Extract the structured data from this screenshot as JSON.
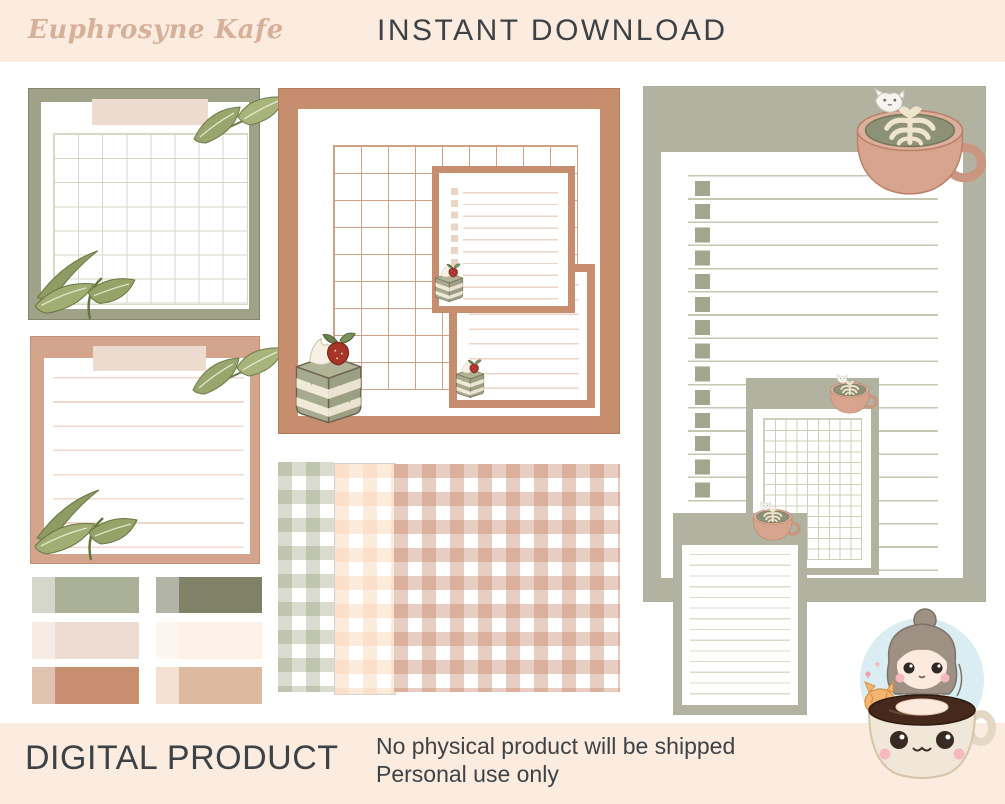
{
  "header": {
    "brand": "Euphrosyne Kafe",
    "title": "INSTANT DOWNLOAD"
  },
  "footer": {
    "label": "DIGITAL PRODUCT",
    "line1": "No physical product will be shipped",
    "line2": "Personal use only"
  },
  "colors": {
    "band_background": "#fcecdf",
    "brand_script": "#d6b098",
    "text_dark": "#3d4246",
    "sage_olive": "#a0a287",
    "sage_gray": "#b1b3a0",
    "tan": "#d3a58c",
    "terracotta": "#c68e6f"
  },
  "palette_swatches": [
    {
      "light": "#d4d7c9",
      "dark": "#a9b096"
    },
    {
      "light": "#b2b4a6",
      "dark": "#808268"
    },
    {
      "light": "#f7ece4",
      "dark": "#eddcd2"
    },
    {
      "light": "#fdf6ef",
      "dark": "#fdf0e6"
    },
    {
      "light": "#e0c2b0",
      "dark": "#c78f6f"
    },
    {
      "light": "#f4e1d4",
      "dark": "#dcba9f"
    }
  ],
  "templates": {
    "calendar_note": {
      "grid_cols": 8,
      "grid_rows": 7
    },
    "lined_note": {
      "lines": 8
    },
    "planner_note": {
      "grid_cols": 9,
      "grid_rows": 9,
      "checklist_rows": 8,
      "memo_lines": 8
    },
    "gingham_sheets": [
      "sage",
      "cream",
      "blush"
    ],
    "checklist_page": {
      "checkbox_rows": 14,
      "lines": 18
    },
    "grid_memo_note": {
      "grid_cols": 9,
      "grid_rows": 13
    },
    "small_memo_note": {
      "lines": 14
    }
  },
  "illustrations": {
    "leaf_sprigs": 4,
    "matcha_cakes": 3,
    "latte_cups": 3,
    "mascot": "girl-in-coffee-cup"
  }
}
